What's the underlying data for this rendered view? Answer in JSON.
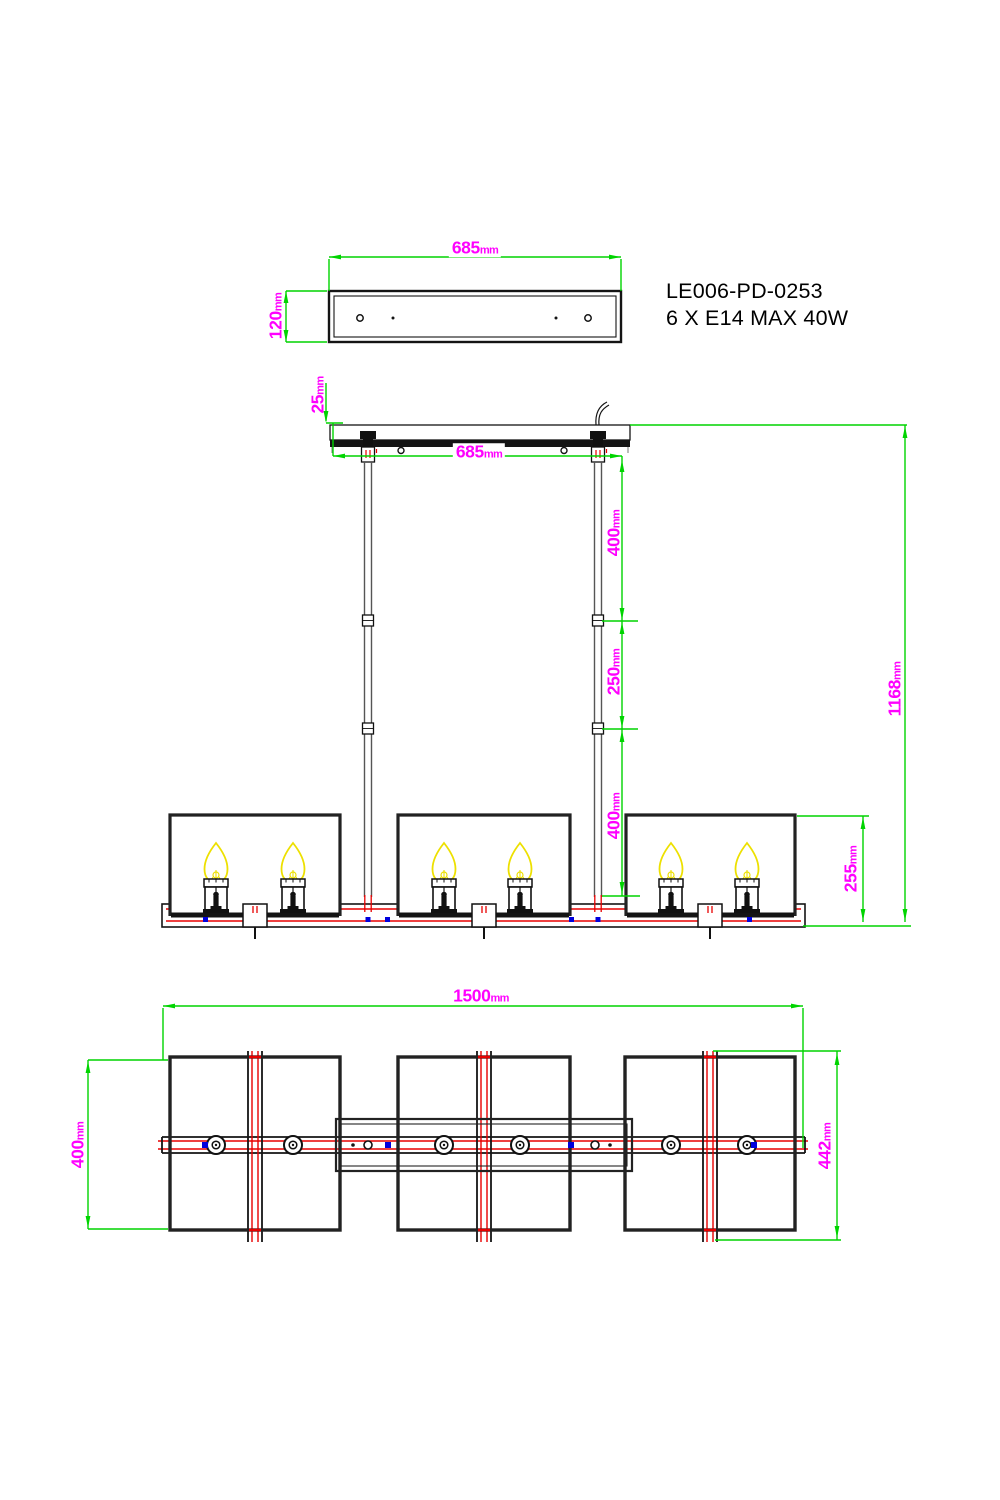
{
  "colors": {
    "dimension_green": "#00d400",
    "label_magenta": "#ff00ff",
    "line_black": "#141414",
    "accent_red": "#e80000",
    "accent_blue": "#0000dd",
    "flame_yellow": "#ede000",
    "rod_gray": "#555555"
  },
  "product": {
    "model": "LE006-PD-0253",
    "spec": "6 X E14 MAX 40W"
  },
  "top_view": {
    "width": {
      "value": "685",
      "unit": "mm"
    },
    "height": {
      "value": "120",
      "unit": "mm"
    }
  },
  "elevation": {
    "canopy_height": {
      "value": "25",
      "unit": "mm"
    },
    "canopy_width": {
      "value": "685",
      "unit": "mm"
    },
    "rod_segment_top": {
      "value": "400",
      "unit": "mm"
    },
    "rod_segment_middle": {
      "value": "250",
      "unit": "mm"
    },
    "rod_segment_bottom": {
      "value": "400",
      "unit": "mm"
    },
    "overall_height": {
      "value": "1168",
      "unit": "mm"
    },
    "shade_height": {
      "value": "255",
      "unit": "mm"
    }
  },
  "plan_view": {
    "overall_length": {
      "value": "1500",
      "unit": "mm"
    },
    "shade_width": {
      "value": "400",
      "unit": "mm"
    },
    "crossbar_length": {
      "value": "442",
      "unit": "mm"
    }
  }
}
